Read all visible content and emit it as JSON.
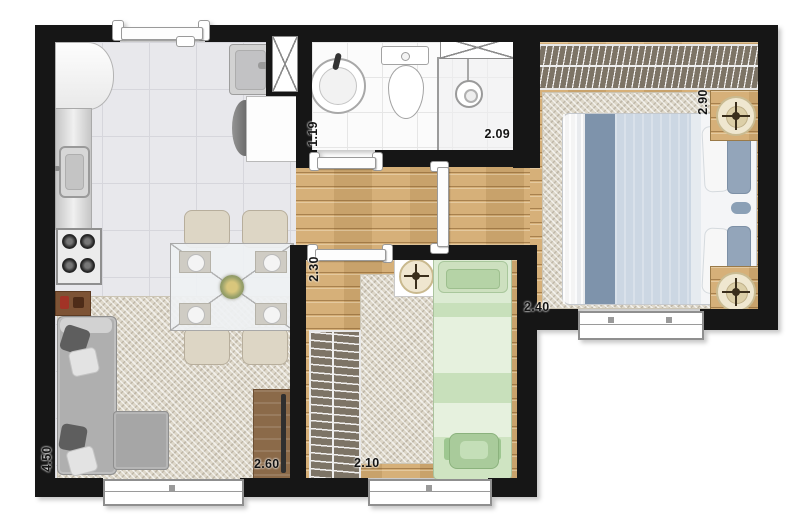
{
  "dimensions": {
    "living": {
      "depth": "4.50",
      "width": "2.60"
    },
    "bathroom": {
      "depth": "1.19",
      "width": "2.09"
    },
    "bedroom_double": {
      "depth": "2.90",
      "width": "2.40"
    },
    "bedroom_single": {
      "depth": "2.30",
      "width": "2.10"
    }
  },
  "colors": {
    "wall": "#161616",
    "wood_floor": "#d3ab71",
    "kitchen_tile": "#e8e8ec",
    "bathroom_tile": "#fbfbfb",
    "rug": "#ddd7c9",
    "wardrobe": "#7d7466",
    "double_bed_blanket": "#7e93ab",
    "single_bed": "#cde0bf",
    "sofa": "#afafaf",
    "tv_stand": "#8b6a49",
    "dining_chair": "#ddd6c5"
  },
  "icons": {
    "stove": "four-burner-stove",
    "sink": "kitchen-sink",
    "shower": "shower-head",
    "toilet": "toilet",
    "washer": "washing-machine"
  }
}
